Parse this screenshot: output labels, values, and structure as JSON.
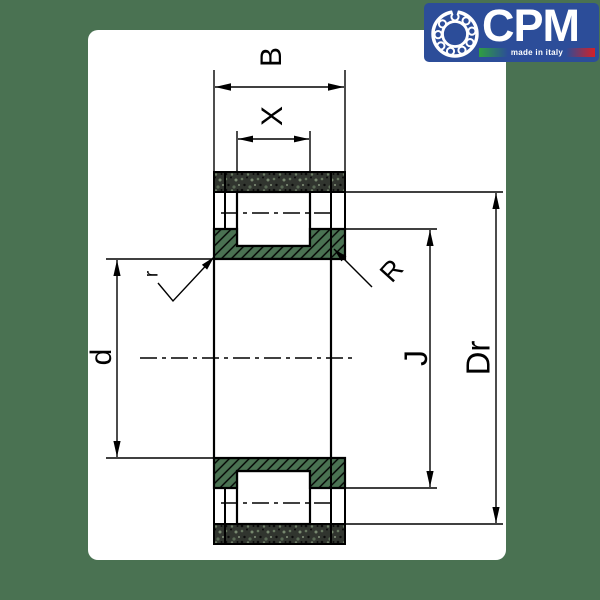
{
  "page": {
    "background": "#4a7252",
    "card_background": "#ffffff",
    "line_color": "#000000"
  },
  "logo": {
    "brand": "CPM",
    "tagline": "made in italy",
    "panel_color": "#2c4d99",
    "flag_green": "#2f9e41",
    "flag_red": "#d42027",
    "icon": "bearing-icon"
  },
  "drawing": {
    "type": "bearing-cross-section",
    "labels": {
      "B": "B",
      "X": "X",
      "d": "d",
      "J": "J",
      "Dr": "Dr",
      "r": "r",
      "R": "R"
    }
  }
}
